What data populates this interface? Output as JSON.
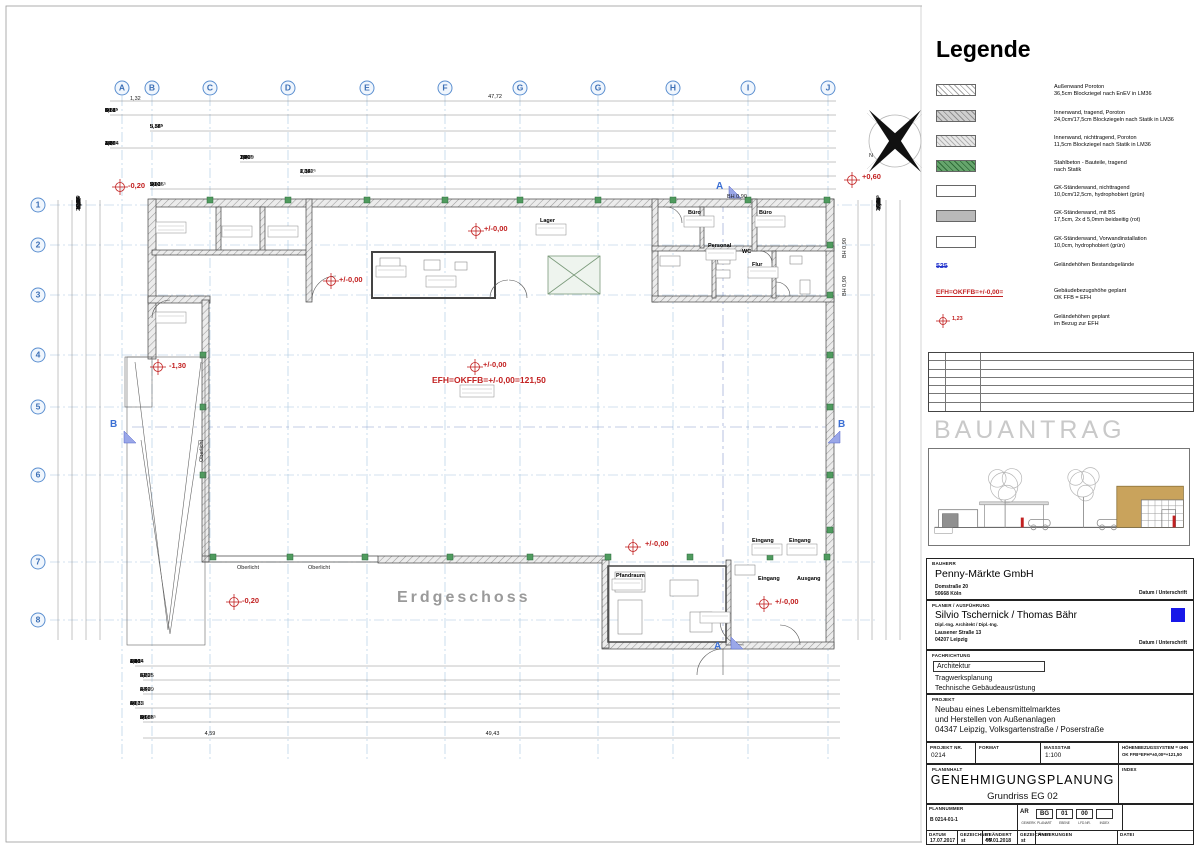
{
  "legend": {
    "title": "Legende",
    "items": [
      {
        "line1": "Außenwand Poroton",
        "line2": "36,5cm Blockziegel nach EnEV in LM36"
      },
      {
        "line1": "Innenwand, tragend, Poroton",
        "line2": "24,0cm/17,5cm Blockziegeln nach Statik in LM36"
      },
      {
        "line1": "Innenwand, nichttragend, Poroton",
        "line2": "11,5cm Blockziegel nach Statik in LM36"
      },
      {
        "line1": "Stahlbeton - Bauteile, tragend",
        "line2": "nach Statik"
      },
      {
        "line1": "GK-Ständerwand, nichttragend",
        "line2": "10,0cm/12,5cm, hydrophobiert (grün)"
      },
      {
        "line1": "GK-Ständerwand, mit BS",
        "line2": "17,5cm, 2x d 5,0mm beidseitig (rot)"
      },
      {
        "line1": "GK-Ständerwand, Vorwandinstallation",
        "line2": "10,0cm, hydrophobiert (grün)"
      },
      {
        "sym": "525",
        "line1": "Geländehöhen Bestandsgelände",
        "line2": ""
      },
      {
        "sym": "EFH=OKFFB=+/-0,00=",
        "line1": "Gebäudebezugshöhe geplant",
        "line2": "OK FFB = EFH"
      },
      {
        "sym": "1,23",
        "line1": "Geländehöhen geplant",
        "line2": "im Bezug zur EFH"
      }
    ]
  },
  "bauantrag": "BAUANTRAG",
  "titleblock": {
    "bauherr": {
      "label": "BAUHERR",
      "name": "Penny-Märkte GmbH",
      "addr1": "Domstraße 20",
      "addr2": "50668 Köln",
      "sig": "Datum / Unterschrift"
    },
    "planer": {
      "label": "PLANER / AUSFÜHRUNG",
      "name": "Silvio Tschernick / Thomas Bähr",
      "title": "Dipl.-Ing. Architekt / Dipl.-Ing.",
      "addr1": "Lausener Straße 13",
      "addr2": "04207 Leipzig",
      "sig": "Datum / Unterschrift"
    },
    "fachrichtung": {
      "label": "FACHRICHTUNG",
      "f1": "Architektur",
      "f2": "Tragwerksplanung",
      "f3": "Technische Gebäudeausrüstung"
    },
    "projekt": {
      "label": "PROJEKT",
      "l1": "Neubau eines Lebensmittelmarktes",
      "l2": "und Herstellen von Außenanlagen",
      "l3": "04347 Leipzig, Volksgartenstraße / Poserstraße"
    },
    "info": {
      "projnr_label": "PROJEKT NR.",
      "projnr": "0214",
      "format_label": "FORMAT",
      "format": "",
      "massstab_label": "MASSSTAB",
      "massstab": "1:100",
      "hoehe1": "HÖHENBEZUGSSYSTEM = üHN",
      "hoehe2": "OK FFB=EFH=±0,00=+121,50"
    },
    "planinhalt": {
      "label": "PLANINHALT",
      "main": "GENEHMIGUNGSPLANUNG",
      "sub": "Grundriss EG 02",
      "index_label": "INDEX"
    },
    "plannummer": {
      "label": "PLANNUMMER",
      "value": "B 0214-01-1",
      "codes": [
        "AR",
        "BG",
        "01",
        "00",
        "",
        ""
      ],
      "code_labels": [
        "GEWERK",
        "PLANART",
        "EBENE",
        "LFD.NR.",
        "INDEX"
      ]
    },
    "dates": {
      "datum_label": "DATUM",
      "datum": "17.07.2017",
      "gez1_label": "GEZEICHNET",
      "gez1": "st",
      "geand_label": "GEÄNDERT AM",
      "geand": "05.01.2018",
      "gez2_label": "GEZEICHNET",
      "gez2": "st",
      "aend_label": "ÄNDERUNGEN",
      "aend": "",
      "datei_label": "DATEI",
      "datei": ""
    }
  },
  "plan": {
    "grid_letters": [
      {
        "label": "A",
        "x": 122
      },
      {
        "label": "B",
        "x": 152
      },
      {
        "label": "C",
        "x": 210
      },
      {
        "label": "D",
        "x": 288
      },
      {
        "label": "E",
        "x": 367
      },
      {
        "label": "F",
        "x": 445
      },
      {
        "label": "G",
        "x": 520
      },
      {
        "label": "G",
        "x": 598
      },
      {
        "label": "H",
        "x": 673
      },
      {
        "label": "I",
        "x": 748
      },
      {
        "label": "J",
        "x": 828
      }
    ],
    "grid_numbers": [
      {
        "label": "1",
        "y": 205
      },
      {
        "label": "2",
        "y": 245
      },
      {
        "label": "3",
        "y": 295
      },
      {
        "label": "4",
        "y": 355
      },
      {
        "label": "5",
        "y": 407
      },
      {
        "label": "6",
        "y": 475
      },
      {
        "label": "7",
        "y": 562
      },
      {
        "label": "8",
        "y": 620
      }
    ],
    "dim_rows": [
      {
        "y": 94,
        "x": 150,
        "w": 690,
        "c": 1,
        "values": [
          "47,72"
        ]
      },
      {
        "y": 108,
        "x": 105,
        "w": 735,
        "values": [
          "10",
          "1,82",
          "4,31",
          "30",
          "5,08⁵",
          "30",
          "5,08⁵",
          "30",
          "5,08⁵",
          "30",
          "5,08⁵",
          "30",
          "5,08⁵",
          "30",
          "5,08⁵",
          "30",
          "5,08⁵",
          "30",
          "5,08",
          "30",
          "2⁵"
        ]
      },
      {
        "y": 124,
        "x": 150,
        "w": 690,
        "values": [
          "9,84⁵",
          "5,38⁵",
          "5,38⁵",
          "5,38⁵",
          "5,38⁵",
          "5,38⁵",
          "5,38⁵",
          "5,55⁵"
        ]
      },
      {
        "y": 141,
        "x": 105,
        "w": 735,
        "values": [
          "34",
          "4,14",
          "15⁵",
          "12",
          "2,60",
          "12⁵",
          "8",
          "2,70",
          "8",
          "25,54",
          "15",
          "3,26",
          "15",
          "2,65⁵",
          "19⁵",
          "4,60",
          "34"
        ]
      },
      {
        "y": 155,
        "x": 240,
        "w": 600,
        "values": [
          "25,09",
          "1⁵",
          "1,60",
          "11⁵",
          "7,80",
          "15",
          "2,07",
          "15⁵",
          "2,47⁵",
          "10",
          "1,36⁵",
          "1,20",
          "34"
        ]
      },
      {
        "y": 169,
        "x": 300,
        "w": 540,
        "values": [
          "27,62⁵",
          "2,12⁵",
          "1,33⁵",
          "1,38",
          "6,04"
        ]
      },
      {
        "y": 182,
        "x": 150,
        "w": 690,
        "values": [
          "3,62⁵",
          "30",
          "2,90",
          "50",
          "7,60",
          "50",
          "2,90",
          "50",
          "7,60",
          "50",
          "2,90",
          "50",
          "17,16⁵"
        ]
      },
      {
        "y": 659,
        "x": 130,
        "w": 715,
        "values": [
          "47",
          "3,68⁵",
          "19",
          "1,10",
          "1,26",
          "2,46",
          "49",
          "4,88⁵",
          "24,14",
          "6",
          "1,26",
          "1,96",
          "65",
          "1,10",
          "1,26",
          "1,10",
          "73",
          "26"
        ]
      },
      {
        "y": 673,
        "x": 140,
        "w": 705,
        "values": [
          "21,75",
          "34",
          "6,89",
          "11⁵",
          "3,32⁵",
          "6",
          "5,22"
        ]
      },
      {
        "y": 687,
        "x": 140,
        "w": 705,
        "values": [
          "4,29",
          "24",
          "27,79",
          "6",
          "2,40",
          "6",
          "2,40",
          "24"
        ]
      },
      {
        "y": 701,
        "x": 130,
        "w": 715,
        "values": [
          "6",
          "20",
          "3,21",
          "60",
          "24",
          "27,12",
          "10,75",
          "4,88",
          "6",
          "26"
        ]
      },
      {
        "y": 715,
        "x": 140,
        "w": 705,
        "values": [
          "4,29",
          "2",
          "30",
          "5,08⁵",
          "30",
          "5,08⁵",
          "30",
          "5,08⁵",
          "30",
          "5,08⁵",
          "30",
          "5,08⁵",
          "30",
          "15,88⁵",
          "30",
          "2⁵"
        ]
      },
      {
        "y": 731,
        "x": 150,
        "w": 120,
        "c": 1,
        "values": [
          "4,59"
        ]
      },
      {
        "y": 731,
        "x": 140,
        "w": 705,
        "c": 1,
        "values": [
          "49,43"
        ]
      }
    ],
    "dims_left": [
      "17",
      "34",
      "1,07",
      "2,77",
      "5,92",
      "3,42⁵",
      "3,26⁵",
      "4,16⁵",
      "25,16⁵",
      "3,90",
      "16,36",
      "5,12",
      "17,56",
      "17,54",
      "5,44⁵",
      "4,28⁵",
      "4,11⁵",
      "17"
    ],
    "dims_right": [
      "34",
      "17",
      "2,26",
      "1,16",
      "2,40",
      "94",
      "24",
      "2,26",
      "1,01⁵",
      "1,54",
      "2,91⁵",
      "16,91⁵",
      "4,50⁵",
      "29,41⁵",
      "6,44⁵",
      "3,20⁵",
      "34"
    ],
    "labels": [
      {
        "t": "-0,20",
        "x": 128,
        "y": 181,
        "k": "red"
      },
      {
        "t": "+0,60",
        "x": 862,
        "y": 172,
        "k": "red"
      },
      {
        "t": "+/-0,00",
        "x": 484,
        "y": 224,
        "k": "red"
      },
      {
        "t": "+/-0,00",
        "x": 339,
        "y": 275,
        "k": "red"
      },
      {
        "t": "+/-0,00",
        "x": 483,
        "y": 360,
        "k": "red"
      },
      {
        "t": "EFH=OKFFB=+/-0,00=121,50",
        "x": 432,
        "y": 375,
        "k": "redbig"
      },
      {
        "t": "+/-0,00",
        "x": 645,
        "y": 539,
        "k": "red"
      },
      {
        "t": "+/-0,00",
        "x": 775,
        "y": 597,
        "k": "red"
      },
      {
        "t": "-0,20",
        "x": 242,
        "y": 596,
        "k": "red"
      },
      {
        "t": "-1,30",
        "x": 169,
        "y": 361,
        "k": "red"
      },
      {
        "t": "Erdgeschoss",
        "x": 397,
        "y": 589,
        "k": "big"
      },
      {
        "t": "Oberlicht",
        "x": 237,
        "y": 565,
        "k": "note"
      },
      {
        "t": "Oberlicht",
        "x": 308,
        "y": 565,
        "k": "note"
      },
      {
        "t": "Oberlicht",
        "x": 199,
        "y": 462,
        "k": "rot"
      },
      {
        "t": "BH 0,90",
        "x": 727,
        "y": 194,
        "k": "note"
      },
      {
        "t": "BH 0,90",
        "x": 842,
        "y": 258,
        "k": "rot"
      },
      {
        "t": "BH 0,90",
        "x": 842,
        "y": 296,
        "k": "rot"
      },
      {
        "t": "N",
        "x": 869,
        "y": 153,
        "k": "note"
      },
      {
        "t": "1,32",
        "x": 130,
        "y": 96,
        "k": "note"
      },
      {
        "t": "Lager",
        "x": 540,
        "y": 218,
        "k": "room"
      },
      {
        "t": "Büro",
        "x": 688,
        "y": 210,
        "k": "room"
      },
      {
        "t": "Büro",
        "x": 759,
        "y": 210,
        "k": "room"
      },
      {
        "t": "Personal",
        "x": 708,
        "y": 243,
        "k": "room"
      },
      {
        "t": "WC",
        "x": 742,
        "y": 249,
        "k": "room"
      },
      {
        "t": "Flur",
        "x": 752,
        "y": 262,
        "k": "room"
      },
      {
        "t": "Pfandraum",
        "x": 616,
        "y": 573,
        "k": "room"
      },
      {
        "t": "Eingang",
        "x": 752,
        "y": 538,
        "k": "room"
      },
      {
        "t": "Eingang",
        "x": 789,
        "y": 538,
        "k": "room"
      },
      {
        "t": "Eingang",
        "x": 758,
        "y": 576,
        "k": "room"
      },
      {
        "t": "Ausgang",
        "x": 797,
        "y": 576,
        "k": "room"
      },
      {
        "t": "A",
        "x": 716,
        "y": 181,
        "k": "sec"
      },
      {
        "t": "A",
        "x": 714,
        "y": 641,
        "k": "sec"
      },
      {
        "t": "B",
        "x": 110,
        "y": 419,
        "k": "sec"
      },
      {
        "t": "B",
        "x": 838,
        "y": 419,
        "k": "sec"
      }
    ]
  }
}
